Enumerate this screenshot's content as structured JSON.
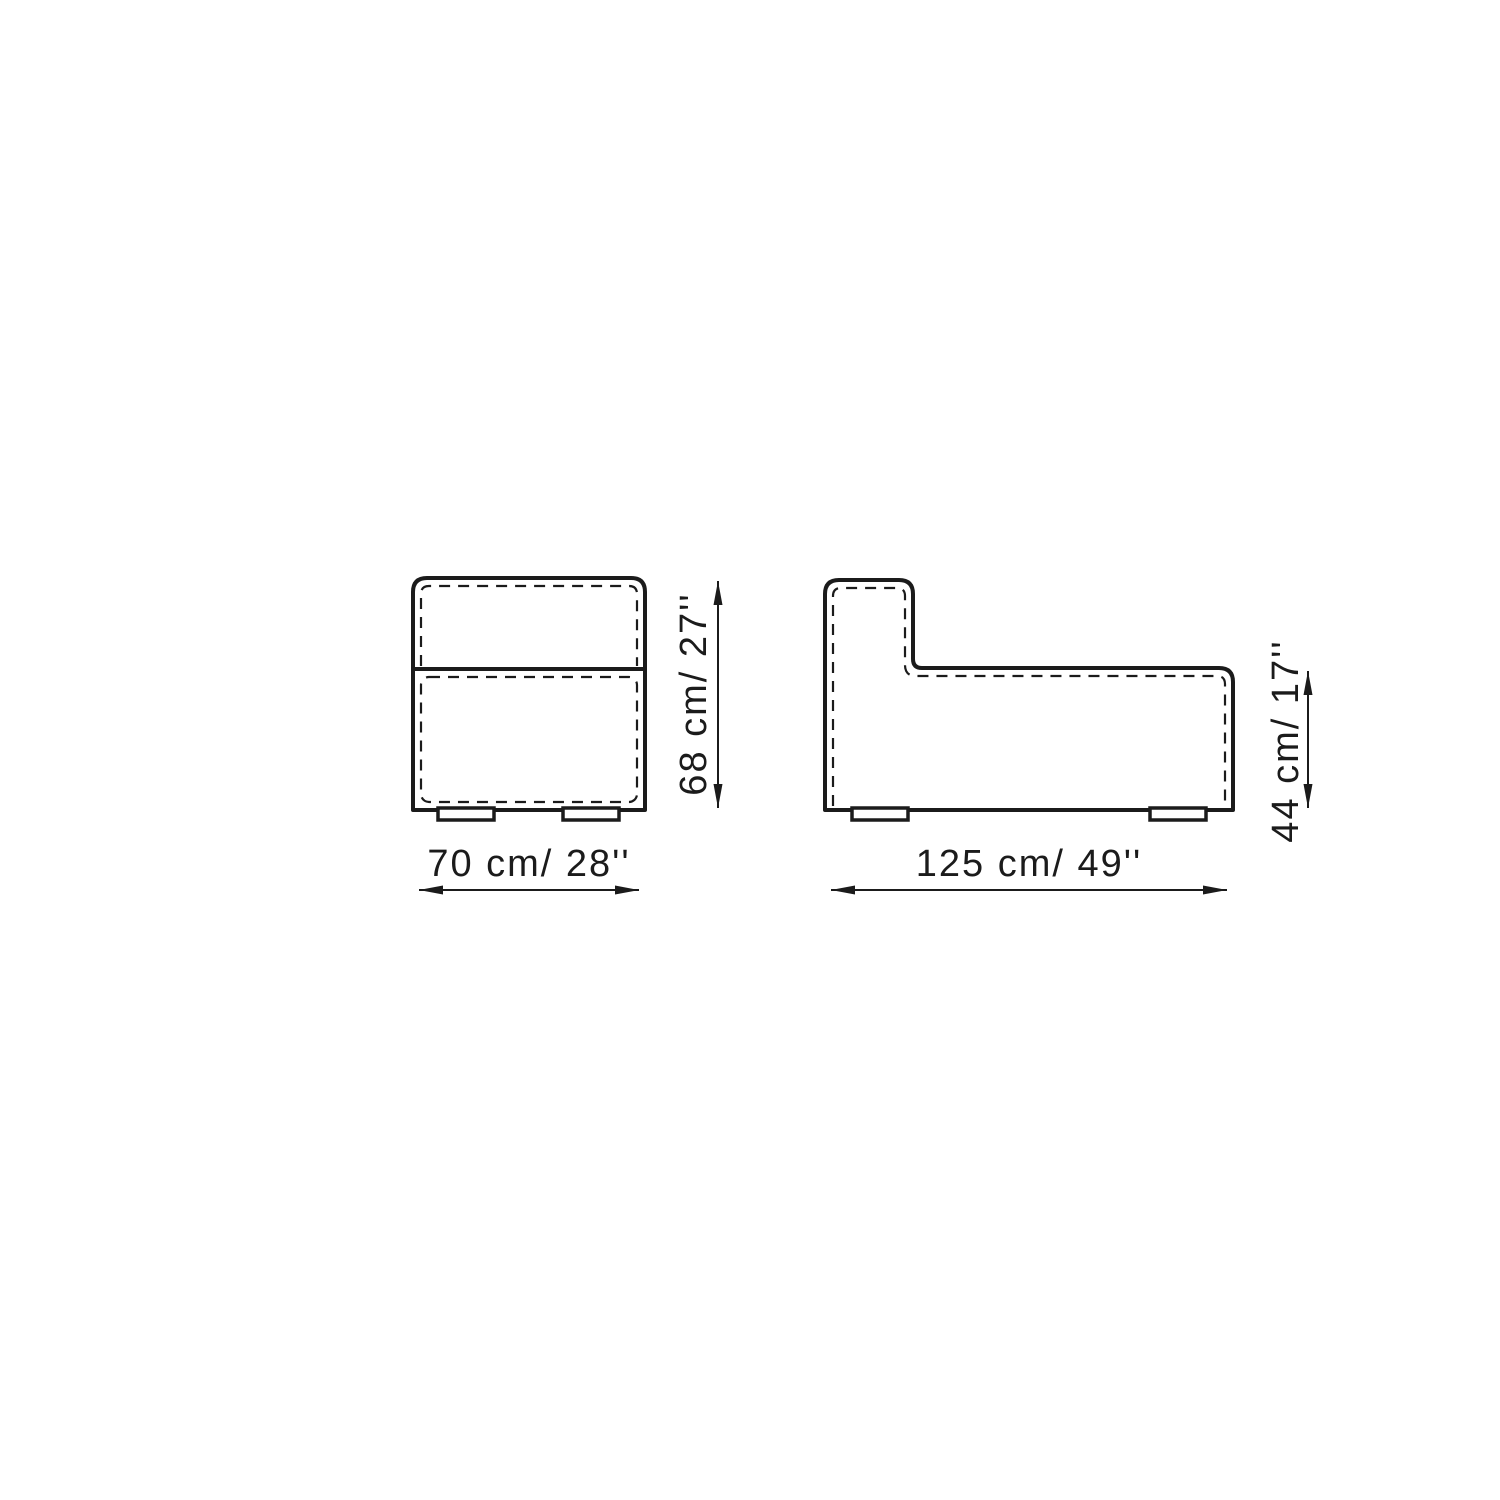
{
  "canvas": {
    "background_color": "#ffffff",
    "line_color": "#1b1b1b"
  },
  "drawing": {
    "kind": "furniture dimension drawing",
    "views": [
      {
        "name": "front view",
        "width_label": "70 cm/ 28''",
        "height_label": "68 cm/ 27''",
        "width_cm": 70,
        "width_in": 28,
        "height_cm": 68,
        "height_in": 27
      },
      {
        "name": "side view",
        "width_label": "125 cm/ 49''",
        "height_label": "44 cm/ 17''",
        "width_cm": 125,
        "width_in": 49,
        "height_cm": 44,
        "height_in": 17
      }
    ]
  }
}
